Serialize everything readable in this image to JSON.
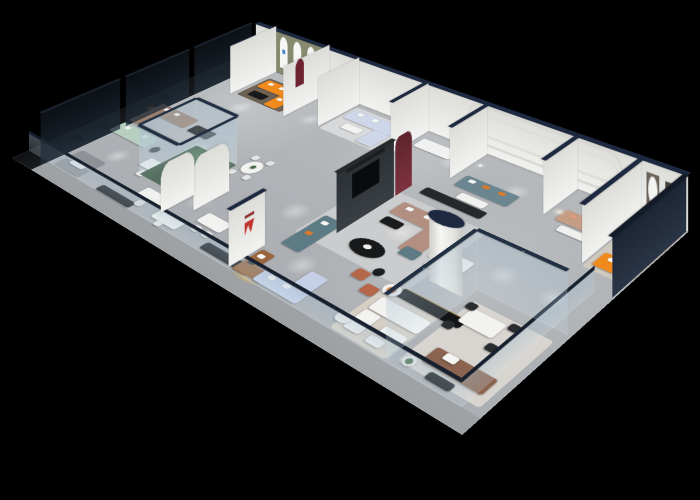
{
  "scene": {
    "title": "3D isometric render of a furniture showroom floor plan on a black background",
    "background": "#000000",
    "view": "cutaway axonometric from above, floor slab rotated with long axis descending to the right"
  },
  "palette": {
    "background": "#000000",
    "floor": "#b2b5b8",
    "walkway": "#a6a9ad",
    "wall_white": "#ecece9",
    "wall_cap_navy": "#1d2940",
    "outer_wall_navy": "#232c3c",
    "smoked_glass": "#1f2a36",
    "clear_glass_tint": "#c6dbe6",
    "charcoal_partition": "#33383c",
    "wine_red_panel": "#6e2a34",
    "olive_arch_wall": "#87896f",
    "maroon_niche": "#6e2430",
    "plant_green": "#4a6b4a",
    "rug_cream": "#d5cfc6",
    "rug_gray": "#cbcccd",
    "rug_dark_taupe": "#6e6257",
    "credenza_black": "#17191b",
    "brass_trim": "#9a7a35"
  },
  "heroes": {
    "sofa_orange": "background:#f08a1d",
    "sofa_mint": "background:#b7cfc0",
    "sofa_powder_blue": "background:#cdd7e9",
    "sofa_slate": "background:#6c8691",
    "sofa_tan_back": "background:#c59c84",
    "sofa_mauve": "background:#b28f80",
    "sofa_teal": "background:#5d7b85",
    "sofa_periwinkle": "background:#c5d0e8",
    "sofa_caramel": "background:#99663d",
    "sofa_brown": "background:#8a6450",
    "sofa_tan_office": "background:#9b8170"
  },
  "logos": {
    "arch_niche_logo_color": "#3f86c9",
    "brand_partition_logo_color": "#c2332b"
  },
  "rooms": [
    {
      "name": "left-private-suites",
      "features": [
        "floor-to-ceiling smoked glass partitions",
        "dark furniture silhouettes",
        "rust accent chair"
      ]
    },
    {
      "name": "left-open-office",
      "features": [
        "tan L-sectional",
        "mint green sofa",
        "gray sofa pair",
        "white desks with chairs",
        "black media credenzas"
      ]
    },
    {
      "name": "arched-niche-lounge",
      "features": [
        "olive wall with three white arched niches",
        "small blue logo",
        "orange L-shaped sofa with white pillows",
        "black coffee table",
        "dark taupe rug"
      ]
    },
    {
      "name": "powder-blue-lounge",
      "features": [
        "powder blue sectional",
        "white coffee table",
        "pale rug"
      ]
    },
    {
      "name": "back-display-bays",
      "features": [
        "white piers with navy caps",
        "slate-blue sofa with orange pillows",
        "tan sofa with salmon pillows",
        "white coffee tables",
        "racetrack wall molding"
      ]
    },
    {
      "name": "planted-glass-atrium",
      "features": [
        "glass enclosure with navy top rails",
        "green planting inside",
        "rounded white pier"
      ]
    },
    {
      "name": "center-media-lounge",
      "features": [
        "charcoal TV partition",
        "wine-red curved panel",
        "teal sofa",
        "black oval coffee table",
        "mauve sectional",
        "teal ottoman",
        "dark wardrobe unit"
      ]
    },
    {
      "name": "front-promenade",
      "features": [
        "glass balustrade with dark top rail",
        "caramel leather sofa",
        "white brand partition with red logo",
        "periwinkle sectional",
        "white dining tables",
        "black credenzas"
      ]
    },
    {
      "name": "white-lounge",
      "features": [
        "white cylindrical column with navy cap",
        "white sofas on cream rug",
        "tulip chair with orange cushion",
        "black sideboard with brass trim",
        "terracotta armchairs",
        "white desk with vases"
      ]
    },
    {
      "name": "front-right-glass-room",
      "features": [
        "clear glass partitions with navy rails",
        "white dining table with four black chairs",
        "brown leather sofa with white throw",
        "potted plant side table"
      ]
    },
    {
      "name": "right-end-orange-suite",
      "features": [
        "orange L-shaped sofa with white pillows",
        "round black side table",
        "oval and square wall art",
        "dark navy outer wall"
      ]
    }
  ]
}
